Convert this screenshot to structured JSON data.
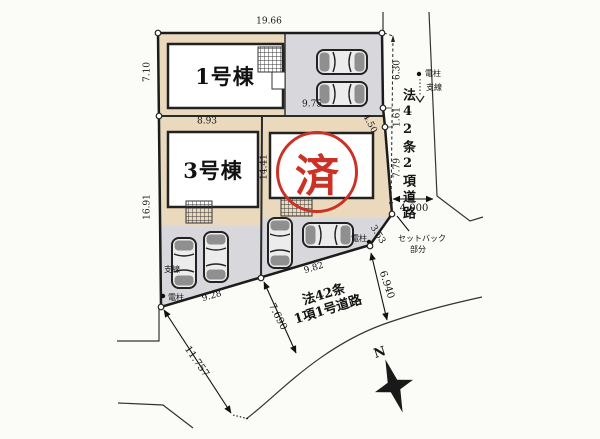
{
  "plan": {
    "type": "site-plan",
    "buildings": {
      "b1_label": "1号棟",
      "b3_label": "3号棟"
    },
    "stamp": {
      "text": "済"
    },
    "dims": {
      "top": "19.66",
      "left_upper": "7.10",
      "left_lower": "16.91",
      "lot3_top": "8.93",
      "parking1": "9.75",
      "divider": "14.41",
      "right_a": "6.30",
      "right_b": "1.61",
      "right_c": "7.79",
      "corner": "4.50",
      "setback_len": "3.53",
      "road_east_width": "4,000",
      "road_south_a": "6.940",
      "road_south_b": "7.690",
      "road_south_c": "11.757",
      "bottom_left": "9.28",
      "bottom_right": "9.82"
    },
    "roads": {
      "east": "法42条2項道路",
      "south_line1": "法42条",
      "south_line2": "1項1号道路"
    },
    "setback": {
      "line1": "セットバック",
      "line2": "部分"
    },
    "poles": {
      "top_pole": "電柱",
      "top_wire": "支線",
      "mid_pole": "電柱",
      "bottom_pole": "電柱",
      "bottom_wire": "支線"
    },
    "compass": {
      "north": "N"
    },
    "colors": {
      "lot_tan": "#ead9bd",
      "parking_gray": "#d8d8dc",
      "building_white": "#ffffff",
      "line_dark": "#1c1c1c",
      "stamp_red": "#cc3126",
      "background": "#fbfbf8"
    }
  }
}
